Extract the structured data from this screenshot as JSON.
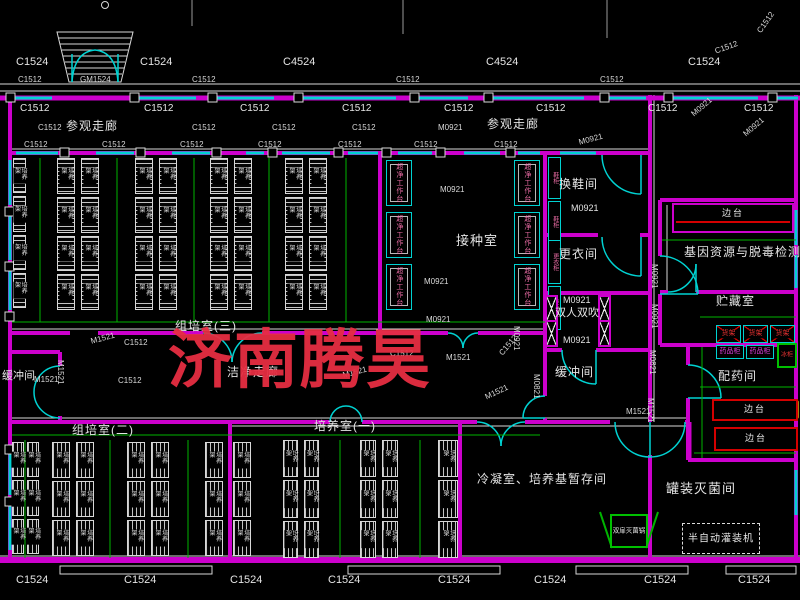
{
  "drawing": {
    "watermark": "济南腾昊"
  },
  "codes": {
    "c1524": "C1524",
    "c4524": "C4524",
    "c1512": "C1512",
    "gm1524": "GM1524",
    "m0921": "M0921",
    "m1521": "M1521",
    "m0821": "M0821"
  },
  "rooms": {
    "visit_corridor": "参观走廊",
    "clean_corridor": "洁净走廊",
    "tissue_culture_3": "组培室(三)",
    "tissue_culture_2": "组培室(二)",
    "culture_1": "培养室(一)",
    "inoculation": "接种室",
    "shoe_change": "换鞋间",
    "dressing": "更衣间",
    "air_shower": "双人双吹",
    "buffer": "缓冲间",
    "condensation_store": "冷凝室、培养基暂存间",
    "gene_detection": "基因资源与脱毒检测室",
    "storage": "贮藏室",
    "dispensing": "配药间",
    "canning": "罐装灭菌间"
  },
  "equipment": {
    "culture_rack": "培养架",
    "clean_bench": "超净工作台",
    "shoe_cabinet": "鞋柜",
    "locker": "更衣柜",
    "goods_shelf": "货架",
    "medicine_cabinet": "药品柜",
    "fridge": "冰柜",
    "side_bench": "边台",
    "sterilizer": "双扉灭菌锅",
    "filling_machine": "半自动灌装机"
  }
}
